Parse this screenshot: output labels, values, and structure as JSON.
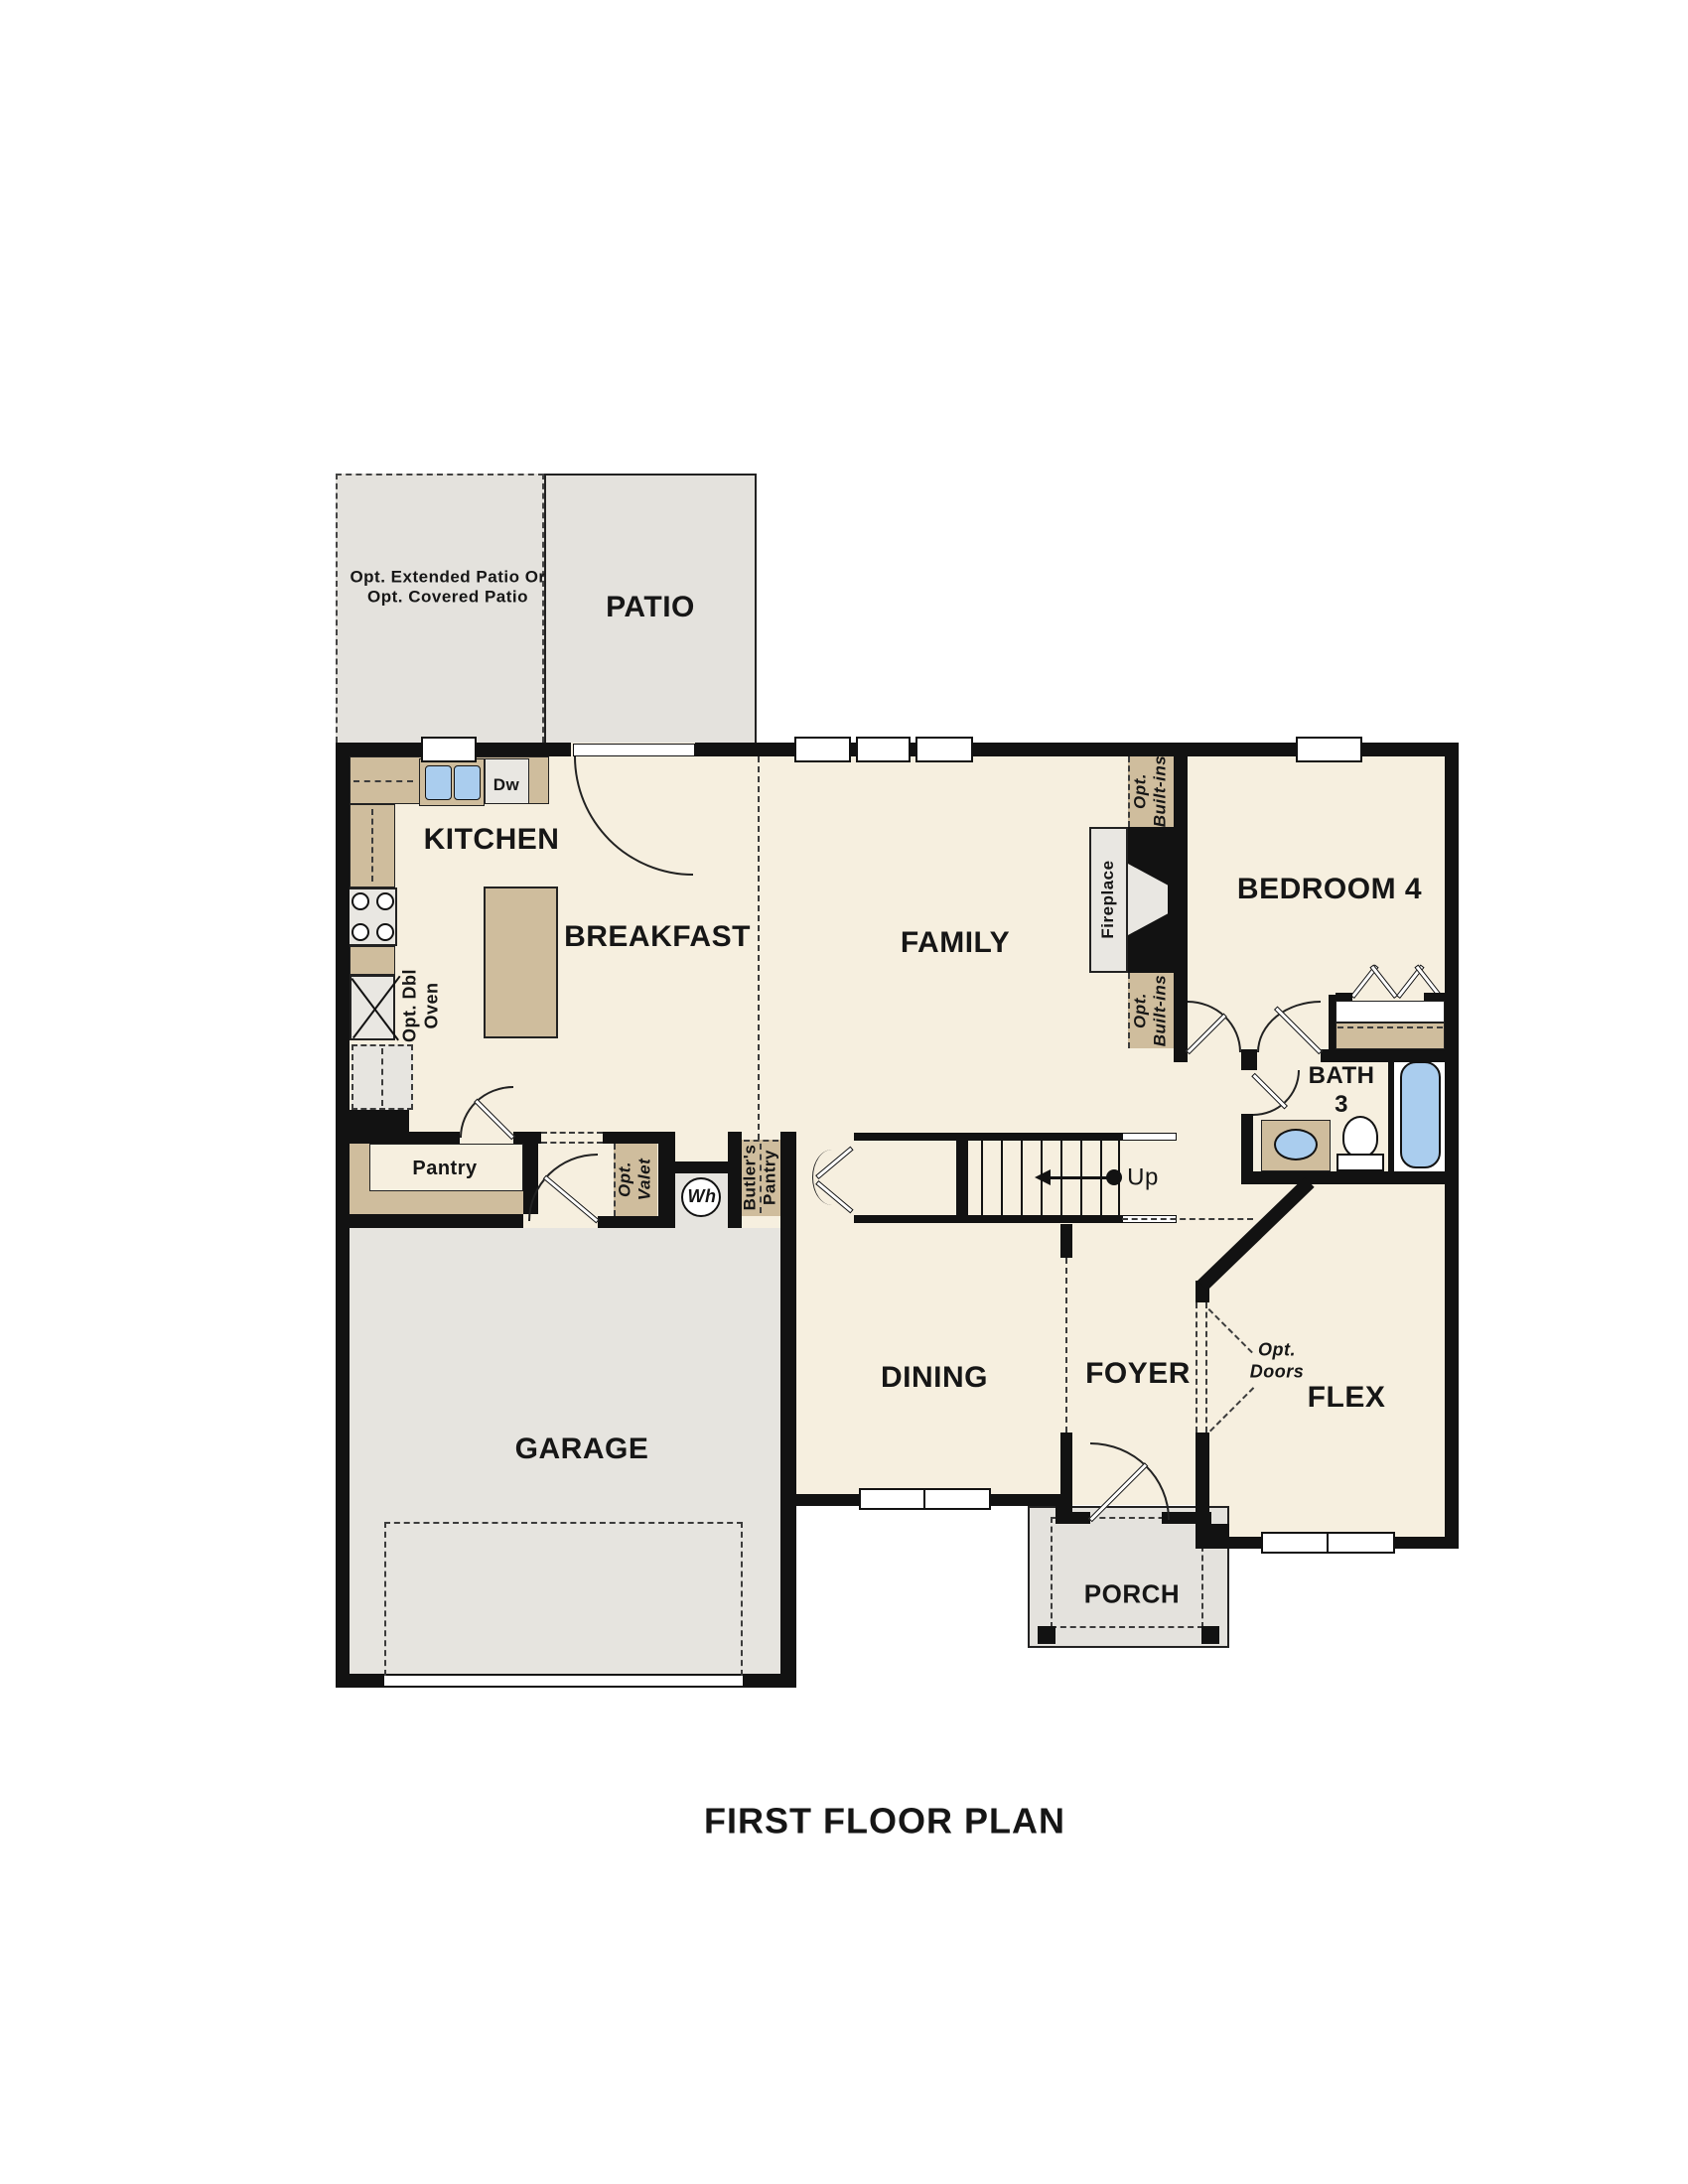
{
  "title": "FIRST FLOOR PLAN",
  "palette": {
    "floor_cream": "#f6efdf",
    "patio_gray": "#e4e2dd",
    "counter_tan": "#cfbd9d",
    "fixture_gray": "#e9e7e2",
    "water_blue": "#aacdee",
    "wall_black": "#121212"
  },
  "rooms": {
    "patio": "PATIO",
    "kitchen": "KITCHEN",
    "breakfast": "BREAKFAST",
    "family": "FAMILY",
    "bedroom4": "BEDROOM 4",
    "bath3": "BATH\n3",
    "dining": "DINING",
    "foyer": "FOYER",
    "flex": "FLEX",
    "porch": "PORCH",
    "garage": "GARAGE"
  },
  "annotations": {
    "opt_patio": "Opt. Extended Patio Or\nOpt. Covered Patio",
    "dw": "Dw",
    "opt_dbl_oven": "Opt. Dbl\nOven",
    "pantry": "Pantry",
    "opt_valet": "Opt.\nValet",
    "wh": "Wh",
    "butlers_pantry": "Butler's\nPantry",
    "opt_builtins_top": "Opt.\nBuilt-ins",
    "opt_builtins_bottom": "Opt.\nBuilt-ins",
    "fireplace": "Fireplace",
    "up": "Up",
    "opt_doors": "Opt.\nDoors"
  }
}
